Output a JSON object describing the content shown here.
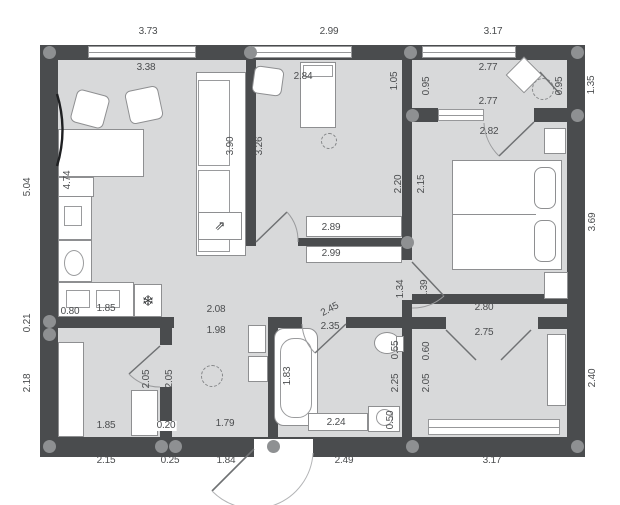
{
  "colors": {
    "wall": "#4a4c4e",
    "floor": "#d8d9da",
    "background": "#ffffff",
    "dimension_text": "#4b4d4f"
  },
  "floor_plan": {
    "icons": {
      "freezer_symbol": "❄",
      "panel_arrow_symbol": "⇗"
    },
    "dimension_labels": [
      {
        "text": "3.73",
        "x": 148,
        "y": 32,
        "rot": 0,
        "area": "exterior-top"
      },
      {
        "text": "2.99",
        "x": 329,
        "y": 32,
        "rot": 0,
        "area": "exterior-top"
      },
      {
        "text": "3.17",
        "x": 493,
        "y": 32,
        "rot": 0,
        "area": "exterior-top"
      },
      {
        "text": "5.04",
        "x": 28,
        "y": 187,
        "rot": -90,
        "area": "exterior-left"
      },
      {
        "text": "0.21",
        "x": 28,
        "y": 323,
        "rot": -90,
        "area": "exterior-left"
      },
      {
        "text": "2.18",
        "x": 28,
        "y": 383,
        "rot": -90,
        "area": "exterior-left"
      },
      {
        "text": "1.35",
        "x": 592,
        "y": 85,
        "rot": -90,
        "area": "exterior-right"
      },
      {
        "text": "3.69",
        "x": 593,
        "y": 222,
        "rot": -90,
        "area": "exterior-right"
      },
      {
        "text": "2.40",
        "x": 593,
        "y": 378,
        "rot": -90,
        "area": "exterior-right"
      },
      {
        "text": "2.15",
        "x": 106,
        "y": 461,
        "rot": 0,
        "area": "exterior-bottom"
      },
      {
        "text": "0.25",
        "x": 170,
        "y": 461,
        "rot": 0,
        "area": "exterior-bottom"
      },
      {
        "text": "1.84",
        "x": 226,
        "y": 461,
        "rot": 0,
        "area": "exterior-bottom"
      },
      {
        "text": "2.49",
        "x": 344,
        "y": 461,
        "rot": 0,
        "area": "exterior-bottom"
      },
      {
        "text": "3.17",
        "x": 492,
        "y": 461,
        "rot": 0,
        "area": "exterior-bottom"
      },
      {
        "text": "3.38",
        "x": 146,
        "y": 68,
        "rot": 0,
        "area": "living-room"
      },
      {
        "text": "4.74",
        "x": 68,
        "y": 180,
        "rot": -90,
        "area": "living-room"
      },
      {
        "text": "3.90",
        "x": 231,
        "y": 146,
        "rot": -90,
        "area": "living-room"
      },
      {
        "text": "0.80",
        "x": 70,
        "y": 312,
        "rot": 0,
        "area": "kitchen"
      },
      {
        "text": "1.85",
        "x": 106,
        "y": 309,
        "rot": 0,
        "area": "kitchen"
      },
      {
        "text": "2.84",
        "x": 303,
        "y": 77,
        "rot": 0,
        "area": "middle-room"
      },
      {
        "text": "3.26",
        "x": 260,
        "y": 146,
        "rot": -90,
        "area": "middle-room"
      },
      {
        "text": "1.05",
        "x": 395,
        "y": 81,
        "rot": -90,
        "area": "middle-room"
      },
      {
        "text": "2.20",
        "x": 399,
        "y": 184,
        "rot": -90,
        "area": "middle-room"
      },
      {
        "text": "2.89",
        "x": 331,
        "y": 228,
        "rot": 0,
        "area": "middle-room-wardrobe"
      },
      {
        "text": "2.99",
        "x": 331,
        "y": 254,
        "rot": 0,
        "area": "hall-wardrobe"
      },
      {
        "text": "0.95",
        "x": 427,
        "y": 86,
        "rot": -90,
        "area": "balcony"
      },
      {
        "text": "2.77",
        "x": 488,
        "y": 68,
        "rot": 0,
        "area": "balcony"
      },
      {
        "text": "2.77",
        "x": 488,
        "y": 102,
        "rot": 0,
        "area": "balcony"
      },
      {
        "text": "0.95",
        "x": 560,
        "y": 86,
        "rot": -90,
        "area": "balcony"
      },
      {
        "text": "2.82",
        "x": 489,
        "y": 132,
        "rot": 0,
        "area": "bedroom"
      },
      {
        "text": "2.15",
        "x": 422,
        "y": 184,
        "rot": -90,
        "area": "bedroom"
      },
      {
        "text": "1.39",
        "x": 425,
        "y": 289,
        "rot": -90,
        "area": "bedroom"
      },
      {
        "text": "1.34",
        "x": 401,
        "y": 289,
        "rot": -90,
        "area": "corridor"
      },
      {
        "text": "2.08",
        "x": 216,
        "y": 310,
        "rot": 0,
        "area": "corridor"
      },
      {
        "text": "2.45",
        "x": 330,
        "y": 310,
        "rot": -28,
        "area": "corridor"
      },
      {
        "text": "2.80",
        "x": 484,
        "y": 308,
        "rot": 0,
        "area": "corridor"
      },
      {
        "text": "1.98",
        "x": 216,
        "y": 331,
        "rot": 0,
        "area": "hallway"
      },
      {
        "text": "2.05",
        "x": 170,
        "y": 379,
        "rot": -90,
        "area": "hallway"
      },
      {
        "text": "1.79",
        "x": 225,
        "y": 424,
        "rot": 0,
        "area": "hallway"
      },
      {
        "text": "2.35",
        "x": 330,
        "y": 327,
        "rot": 0,
        "area": "bathroom"
      },
      {
        "text": "1.83",
        "x": 288,
        "y": 376,
        "rot": -90,
        "area": "bathroom"
      },
      {
        "text": "0.55",
        "x": 396,
        "y": 350,
        "rot": -90,
        "area": "bathroom"
      },
      {
        "text": "2.25",
        "x": 396,
        "y": 383,
        "rot": -90,
        "area": "bathroom"
      },
      {
        "text": "2.24",
        "x": 336,
        "y": 423,
        "rot": 0,
        "area": "bathroom"
      },
      {
        "text": "0.50",
        "x": 391,
        "y": 420,
        "rot": -90,
        "area": "bathroom"
      },
      {
        "text": "2.75",
        "x": 484,
        "y": 333,
        "rot": 0,
        "area": "dressing-room"
      },
      {
        "text": "0.60",
        "x": 427,
        "y": 351,
        "rot": -90,
        "area": "dressing-room"
      },
      {
        "text": "2.05",
        "x": 427,
        "y": 383,
        "rot": -90,
        "area": "dressing-room"
      },
      {
        "text": "1.85",
        "x": 106,
        "y": 426,
        "rot": 0,
        "area": "small-room"
      },
      {
        "text": "2.05",
        "x": 147,
        "y": 379,
        "rot": -90,
        "area": "small-room"
      },
      {
        "text": "0.20",
        "x": 166,
        "y": 426,
        "rot": 0,
        "bg": true,
        "area": "small-room"
      }
    ]
  }
}
